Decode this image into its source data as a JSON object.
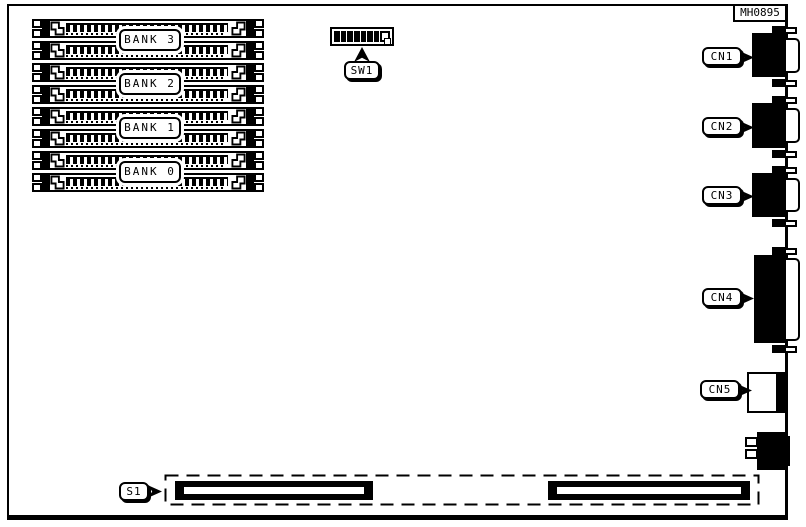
{
  "board": {
    "part_number": "MH0895",
    "banks": [
      {
        "label": "BANK 3"
      },
      {
        "label": "BANK 2"
      },
      {
        "label": "BANK 1"
      },
      {
        "label": "BANK 0"
      }
    ],
    "dip_switch": {
      "label": "SW1",
      "total_positions": 8,
      "dark_positions": 7
    },
    "connectors": [
      {
        "label": "CN1"
      },
      {
        "label": "CN2"
      },
      {
        "label": "CN3"
      },
      {
        "label": "CN4"
      },
      {
        "label": "CN5"
      }
    ],
    "edge_connector": {
      "label": "S1"
    },
    "colors": {
      "ink": "#000000",
      "background": "#ffffff"
    }
  }
}
